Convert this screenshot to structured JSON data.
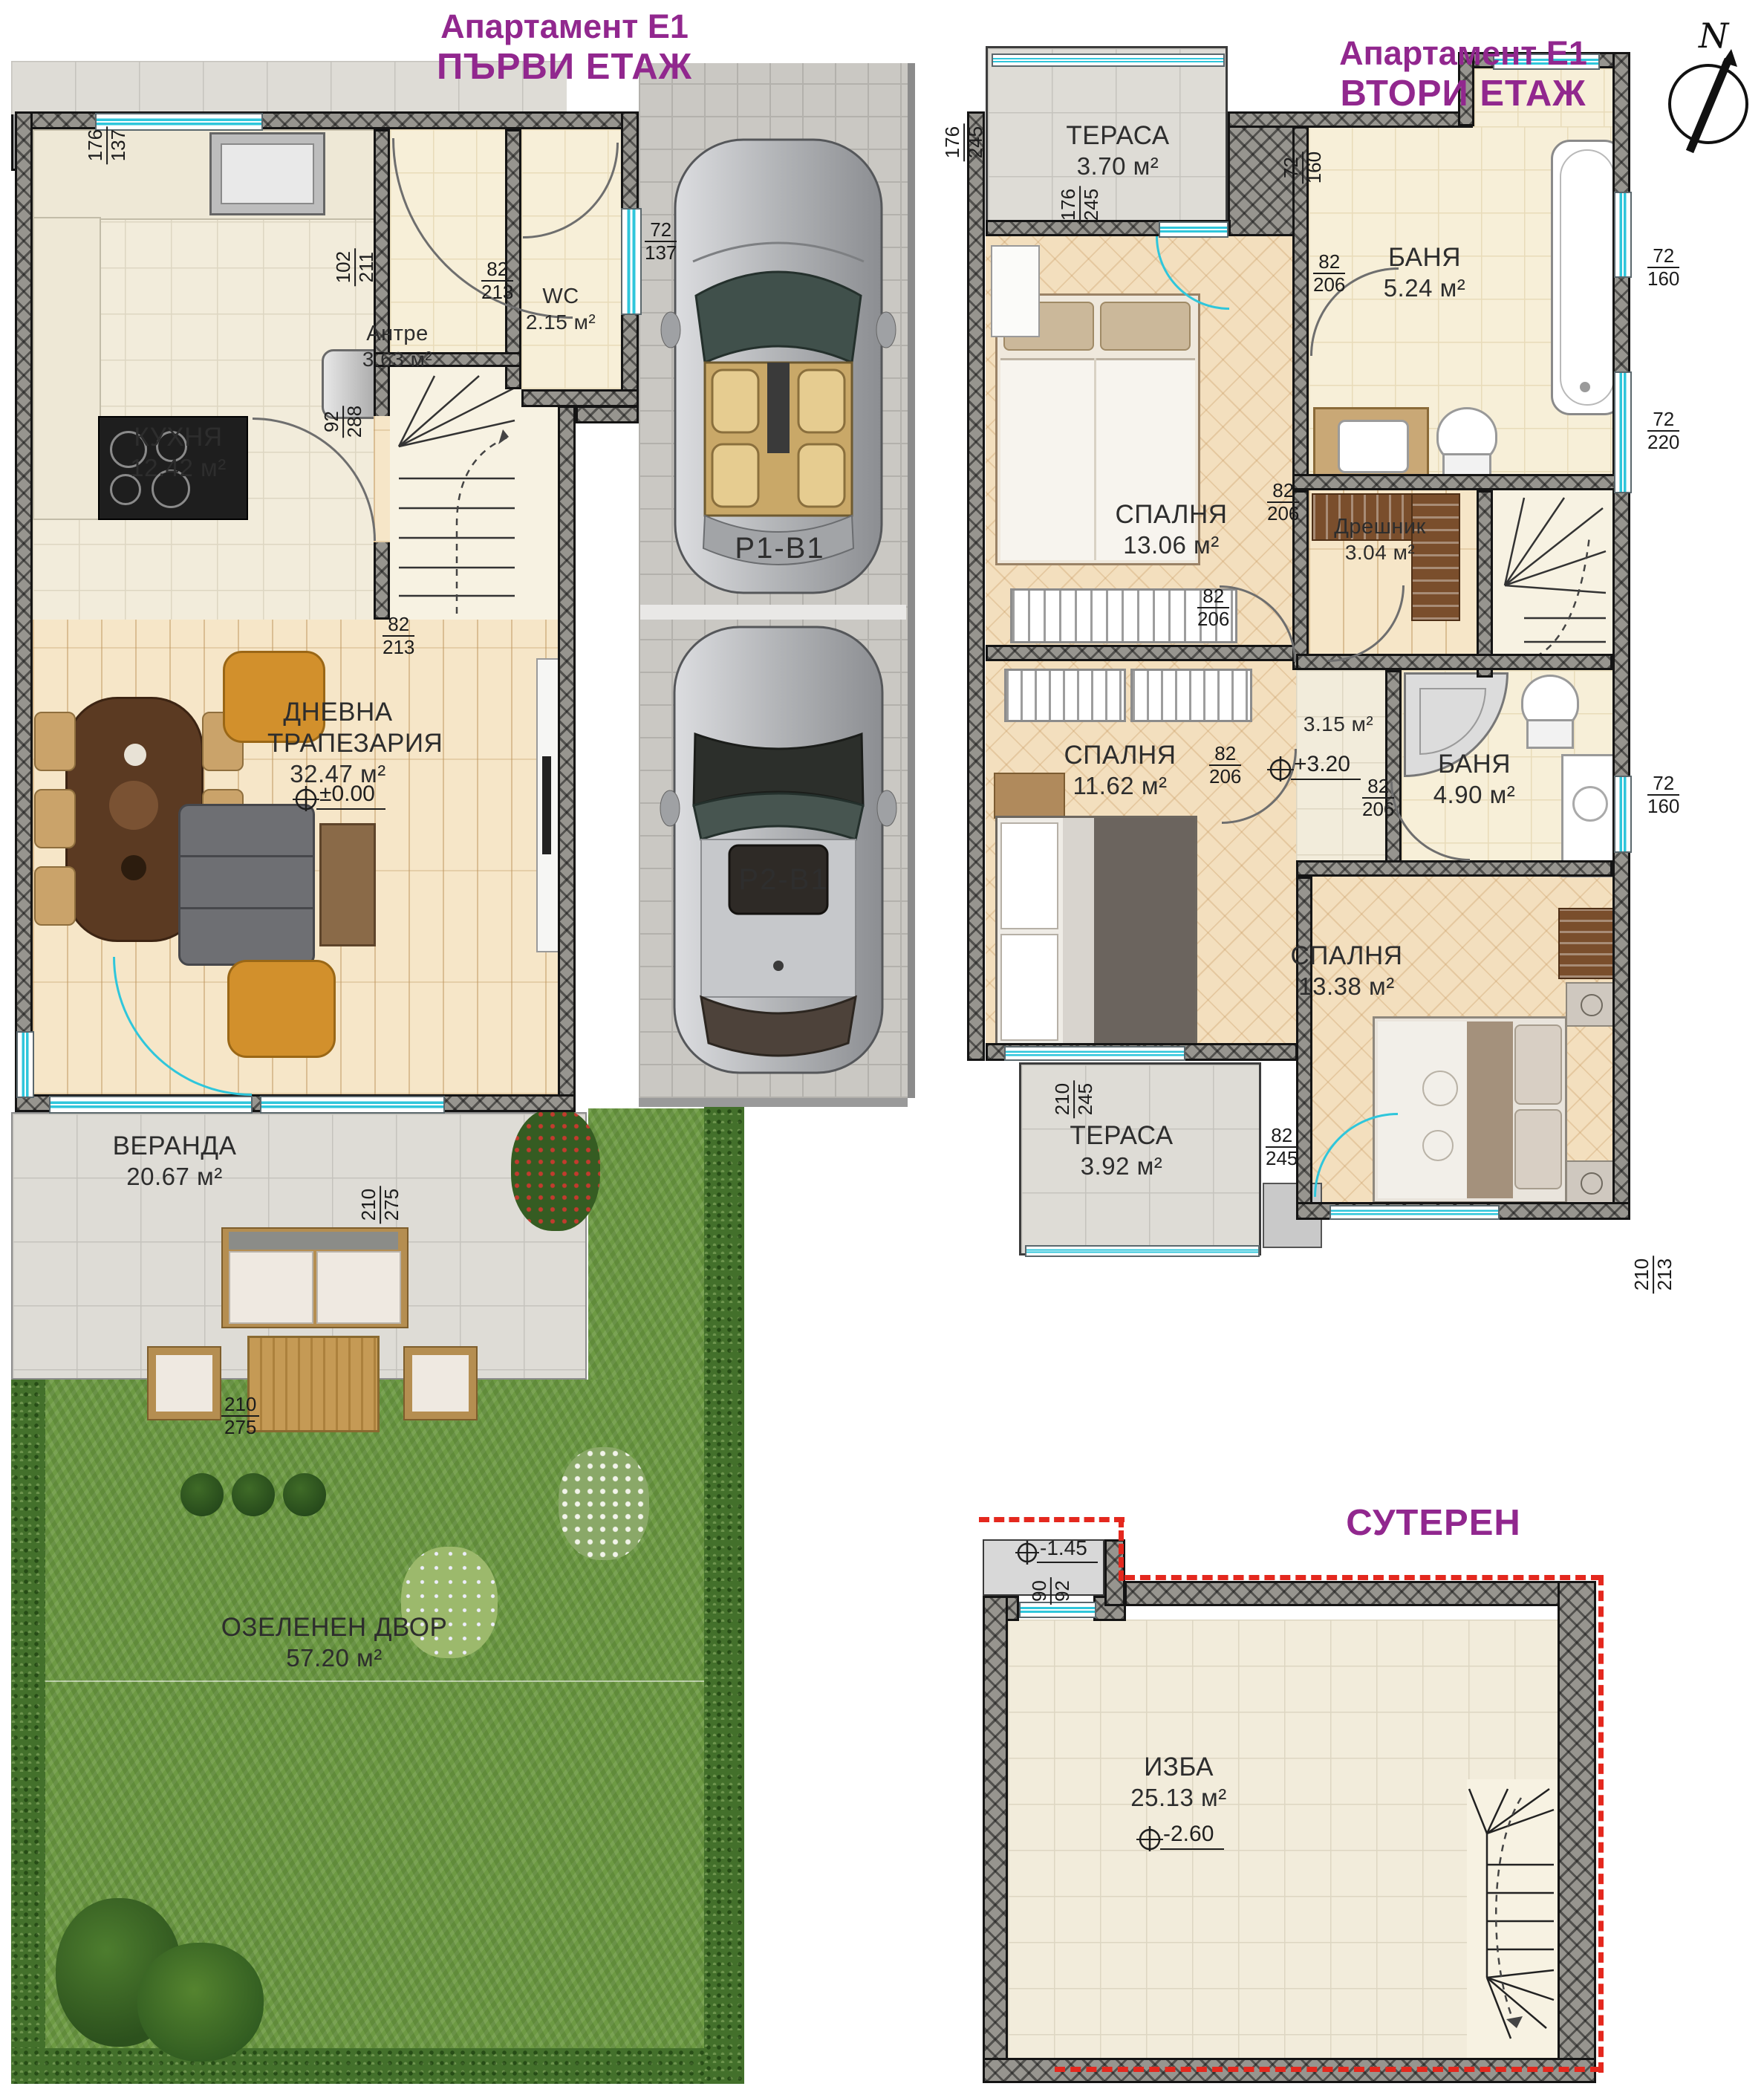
{
  "units": {
    "m2": "м²"
  },
  "floor1": {
    "title1": "Апартамент E1",
    "title2": "ПЪРВИ ЕТАЖ",
    "kitchen": {
      "name": "КУХНЯ",
      "area": "12.42"
    },
    "entry": {
      "name": "Антре",
      "area": "3.63"
    },
    "wc": {
      "name": "WC",
      "area": "2.15"
    },
    "living": {
      "name1": "ДНЕВНА",
      "name2": "ТРАПЕЗАРИЯ",
      "area": "32.47",
      "level": "±0.00"
    },
    "veranda": {
      "name": "ВЕРАНДА",
      "area": "20.67"
    },
    "yard": {
      "name": "ОЗЕЛЕНЕН ДВОР",
      "area": "57.20"
    },
    "parking1": "P1-B1",
    "parking2": "P2-B1",
    "dims": {
      "d1": {
        "top": "176",
        "bottom": "137"
      },
      "d2": {
        "top": "102",
        "bottom": "211"
      },
      "d3": {
        "top": "82",
        "bottom": "213"
      },
      "d4": {
        "top": "72",
        "bottom": "137"
      },
      "d5": {
        "top": "92",
        "bottom": "288"
      },
      "d6": {
        "top": "82",
        "bottom": "213"
      },
      "d7": {
        "top": "210",
        "bottom": "275"
      },
      "d8": {
        "top": "210",
        "bottom": "275"
      }
    }
  },
  "floor2": {
    "title1": "Апартамент E1",
    "title2": "ВТОРИ ЕТАЖ",
    "compass": "N",
    "terrace1": {
      "name": "ТЕРАСА",
      "area": "3.70"
    },
    "bath1": {
      "name": "БАНЯ",
      "area": "5.24"
    },
    "bedroom1": {
      "name": "СПАЛНЯ",
      "area": "13.06"
    },
    "dresser": {
      "name": "Дрешник",
      "area": "3.04"
    },
    "bedroom2": {
      "name": "СПАЛНЯ",
      "area": "11.62"
    },
    "corridor": {
      "area": "3.15",
      "level": "+3.20"
    },
    "bath2": {
      "name": "БАНЯ",
      "area": "4.90"
    },
    "bedroom3": {
      "name": "СПАЛНЯ",
      "area": "13.38"
    },
    "terrace2": {
      "name": "ТЕРАСА",
      "area": "3.92"
    },
    "dims": {
      "d1": {
        "top": "176",
        "bottom": "245"
      },
      "d2": {
        "top": "176",
        "bottom": "245"
      },
      "d3": {
        "top": "72",
        "bottom": "160"
      },
      "d4": {
        "top": "82",
        "bottom": "206"
      },
      "d5": {
        "top": "82",
        "bottom": "206"
      },
      "d6": {
        "top": "82",
        "bottom": "206"
      },
      "d7": {
        "top": "82",
        "bottom": "206"
      },
      "d8": {
        "top": "82",
        "bottom": "206"
      },
      "d9": {
        "top": "72",
        "bottom": "160"
      },
      "d10": {
        "top": "72",
        "bottom": "220"
      },
      "d11": {
        "top": "72",
        "bottom": "160"
      },
      "d12": {
        "top": "210",
        "bottom": "245"
      },
      "d13": {
        "top": "82",
        "bottom": "245"
      },
      "d14": {
        "top": "210",
        "bottom": "213"
      }
    }
  },
  "basement": {
    "title": "СУТЕРЕН",
    "cellar": {
      "name": "ИЗБА",
      "area": "25.13",
      "level": "-2.60"
    },
    "entry_level": "-1.45",
    "dims": {
      "d1": {
        "top": "90",
        "bottom": "92"
      }
    }
  }
}
